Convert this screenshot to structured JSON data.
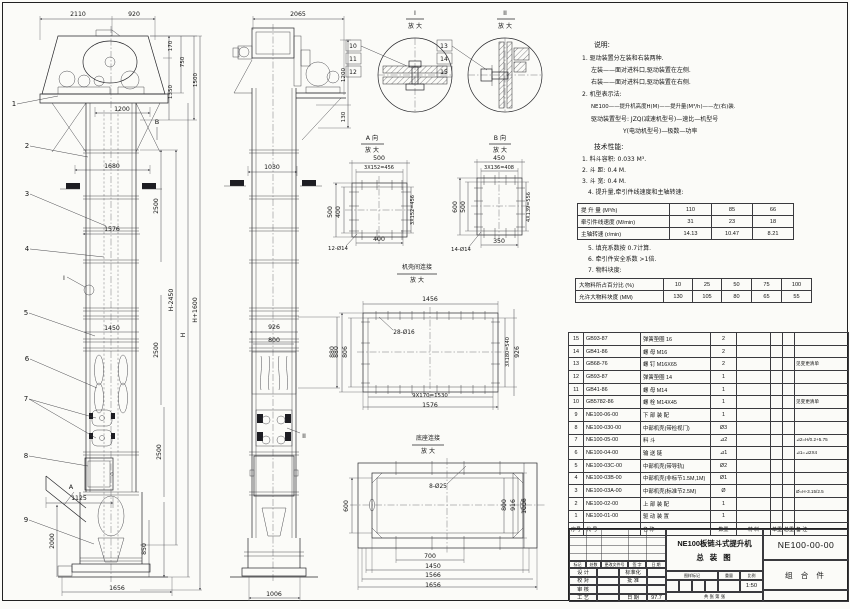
{
  "sheet": {
    "kind": "engineering-assembly-drawing"
  },
  "notes_labels": [
    [
      "说明:",
      594,
      47,
      0,
      6.8,
      "s"
    ],
    [
      "1. 驱动装置分左装和右装两种.",
      582,
      60,
      0,
      6,
      "s"
    ],
    [
      "左装——面对进料口,驱动装置在左侧.",
      591,
      72,
      0,
      6,
      "s"
    ],
    [
      "右装——面对进料口,驱动装置在右侧.",
      591,
      84,
      0,
      6,
      "s"
    ],
    [
      "2. 机型表示法:",
      582,
      96,
      0,
      6,
      "s"
    ],
    [
      "NE100——提升机高度H(M)——提升量(M³/h)——左(右)装.",
      591,
      108,
      0,
      5.4,
      "s"
    ],
    [
      "驱动装置型号: JZQ(减速机型号)—速比—机型号",
      591,
      121,
      0,
      6,
      "s"
    ],
    [
      "Y(电动机型号)—极数—功率",
      623,
      133,
      0,
      6,
      "s"
    ],
    [
      "技术性能:",
      594,
      149,
      0,
      6.8,
      "s"
    ],
    [
      "1. 料斗容积: 0.033 M³.",
      582,
      161,
      0,
      6,
      "s"
    ],
    [
      "2. 斗  距: 0.4 M.",
      582,
      172,
      0,
      6,
      "s"
    ],
    [
      "3. 斗  宽: 0.4 M.",
      582,
      183,
      0,
      6,
      "s"
    ],
    [
      "4. 提升量,牵引件线速度和主轴转速:",
      588,
      194,
      0,
      6,
      "s"
    ],
    [
      "5. 填充系数按 0.7计算.",
      588,
      250,
      0,
      6,
      "s"
    ],
    [
      "6. 牵引件安全系数 >1倍.",
      588,
      261,
      0,
      6,
      "s"
    ],
    [
      "7. 物料块度:",
      588,
      272,
      0,
      6,
      "s"
    ]
  ],
  "drawing_labels": [
    [
      "2110",
      78,
      16
    ],
    [
      "920",
      134,
      16
    ],
    [
      "170",
      172,
      46,
      -90,
      5.6
    ],
    [
      "750",
      184,
      62,
      -90,
      5.6
    ],
    [
      "1350",
      172,
      92,
      -90,
      5.6
    ],
    [
      "1500",
      197,
      80,
      -90,
      5.6
    ],
    [
      "1",
      14,
      106,
      0,
      7
    ],
    [
      "1200",
      122,
      111
    ],
    [
      "B",
      157,
      124,
      0,
      6.5
    ],
    [
      "2",
      27,
      148,
      0,
      7
    ],
    [
      "1680",
      112,
      168
    ],
    [
      "2500",
      158,
      206,
      -90
    ],
    [
      "3",
      27,
      196,
      0,
      7
    ],
    [
      "1576",
      112,
      231
    ],
    [
      "4",
      27,
      251,
      0,
      7
    ],
    [
      "I",
      64,
      280,
      0,
      6.5
    ],
    [
      "H-2450",
      173,
      300,
      -90
    ],
    [
      "H",
      185,
      335,
      -90
    ],
    [
      "H+1600",
      197,
      310,
      -90
    ],
    [
      "5",
      26,
      315,
      0,
      7
    ],
    [
      "1450",
      112,
      330
    ],
    [
      "2500",
      158,
      350,
      -90
    ],
    [
      "6",
      27,
      361,
      0,
      7
    ],
    [
      "7",
      26,
      401,
      0,
      7
    ],
    [
      "2500",
      161,
      452,
      -90
    ],
    [
      "8",
      26,
      458,
      0,
      7
    ],
    [
      "A",
      71,
      489,
      0,
      6.5
    ],
    [
      "1125",
      79,
      500
    ],
    [
      "9",
      26,
      522,
      0,
      7
    ],
    [
      "2000",
      54,
      541,
      -90
    ],
    [
      "850",
      146,
      549,
      -90
    ],
    [
      "1656",
      117,
      590
    ],
    [
      "2065",
      298,
      16
    ],
    [
      "1200",
      345,
      75,
      -90,
      5.6
    ],
    [
      "130",
      345,
      117,
      -90,
      5.6
    ],
    [
      "1030",
      272,
      169
    ],
    [
      "926",
      274,
      329
    ],
    [
      "800",
      274,
      342
    ],
    [
      "880",
      334,
      352,
      -90
    ],
    [
      "II",
      304,
      438,
      0,
      6.5
    ],
    [
      "1006",
      274,
      596
    ],
    [
      "I",
      415,
      15,
      0,
      6.5
    ],
    [
      "放 大",
      415,
      28,
      0,
      6
    ],
    [
      "10",
      353,
      48,
      0,
      6
    ],
    [
      "11",
      353,
      61,
      0,
      6
    ],
    [
      "12",
      353,
      74,
      0,
      6
    ],
    [
      "II",
      505,
      15,
      0,
      6.5
    ],
    [
      "放 大",
      505,
      28,
      0,
      6
    ],
    [
      "13",
      444,
      48,
      0,
      6
    ],
    [
      "14",
      444,
      61,
      0,
      6
    ],
    [
      "15",
      444,
      74,
      0,
      6
    ],
    [
      "A 向",
      372,
      140,
      0,
      6.2
    ],
    [
      "放 大",
      372,
      152,
      0,
      6
    ],
    [
      "500",
      379,
      160
    ],
    [
      "3X152=456",
      379,
      169,
      0,
      5
    ],
    [
      "500",
      332,
      212,
      -90
    ],
    [
      "400",
      340,
      212,
      -90
    ],
    [
      "3X152=456",
      414,
      210,
      -90,
      5
    ],
    [
      "400",
      379,
      241
    ],
    [
      "12-Ø14",
      338,
      250,
      0,
      5.4
    ],
    [
      "B 向",
      500,
      140,
      0,
      6.2
    ],
    [
      "放 大",
      500,
      152,
      0,
      6
    ],
    [
      "450",
      499,
      160
    ],
    [
      "3X136=408",
      499,
      169,
      0,
      5
    ],
    [
      "600",
      457,
      207,
      -90
    ],
    [
      "500",
      465,
      207,
      -90
    ],
    [
      "4X139=556",
      530,
      207,
      -90,
      5
    ],
    [
      "350",
      499,
      243
    ],
    [
      "14-Ø14",
      461,
      251,
      0,
      5.4
    ],
    [
      "机壳间连接",
      417,
      269,
      0,
      6
    ],
    [
      "放 大",
      417,
      282,
      0,
      6
    ],
    [
      "1456",
      430,
      301
    ],
    [
      "28-Ø16",
      404,
      334,
      0,
      5.8
    ],
    [
      "880",
      338,
      352,
      -90
    ],
    [
      "806",
      347,
      352,
      -90
    ],
    [
      "3X180=540",
      509,
      352,
      -90,
      5
    ],
    [
      "926",
      519,
      352,
      -90
    ],
    [
      "9X170=1530",
      430,
      397,
      0,
      5.4
    ],
    [
      "1576",
      430,
      407
    ],
    [
      "底座连接",
      428,
      440,
      0,
      6
    ],
    [
      "放 大",
      428,
      453,
      0,
      6
    ],
    [
      "8-Ø25",
      438,
      488,
      0,
      5.8
    ],
    [
      "600",
      348,
      506,
      -90
    ],
    [
      "800",
      506,
      505,
      -90
    ],
    [
      "916",
      515,
      505,
      -90
    ],
    [
      "1006",
      526,
      506,
      -90
    ],
    [
      "700",
      430,
      558
    ],
    [
      "1450",
      433,
      568
    ],
    [
      "1566",
      433,
      577
    ],
    [
      "1656",
      433,
      587
    ]
  ],
  "spec_table_lift": {
    "cols": [
      92,
      42,
      41,
      41
    ],
    "rows": [
      [
        "提 升 量  (M³/h)",
        "110",
        "85",
        "66"
      ],
      [
        "牵引件线速度 (M/min)",
        "31",
        "23",
        "18"
      ],
      [
        "主轴转速 (r/min)",
        "14.13",
        "10.47",
        "8.21"
      ]
    ]
  },
  "spec_table_lump": {
    "cols": [
      88,
      29,
      29,
      30,
      30,
      30
    ],
    "rows": [
      [
        "大物料所占百分比 (%)",
        "10",
        "25",
        "50",
        "75",
        "100"
      ],
      [
        "允许大物料块度 (MM)",
        "130",
        "105",
        "80",
        "65",
        "55"
      ]
    ]
  },
  "bom": {
    "cols": [
      15,
      57,
      70,
      26,
      34,
      12,
      12,
      54
    ],
    "rows": [
      [
        "15",
        "GB93-87",
        "弹簧垫圈 16",
        "2",
        "",
        "",
        "",
        ""
      ],
      [
        "14",
        "GB41-86",
        "螺 母 M16",
        "2",
        "",
        "",
        "",
        ""
      ],
      [
        "13",
        "GB68-76",
        "螺 钉 M16X65",
        "2",
        "",
        "",
        "",
        "见变更清单"
      ],
      [
        "12",
        "GB93-87",
        "弹簧垫圈 14",
        "1",
        "",
        "",
        "",
        ""
      ],
      [
        "11",
        "GB41-86",
        "螺 母 M14",
        "1",
        "",
        "",
        "",
        ""
      ],
      [
        "10",
        "GB5782-86",
        "螺 栓 M14X45",
        "1",
        "",
        "",
        "",
        "见变更清单"
      ],
      [
        "9",
        "NE100-06-00",
        "下 部 装 配",
        "1",
        "",
        "",
        "",
        ""
      ],
      [
        "8",
        "NE100-030-00",
        "中部机壳(带检视门)",
        "Ø3",
        "",
        "",
        "",
        ""
      ],
      [
        "7",
        "NE100-05-00",
        "料 斗",
        "⊿2",
        "",
        "",
        "",
        "⊿2=H/0.2+5.75"
      ],
      [
        "6",
        "NE100-04-00",
        "输 送 链",
        "⊿1",
        "",
        "",
        "",
        "⊿1=⊿2X4"
      ],
      [
        "5",
        "NE100-03C-00",
        "中部机壳(带导轨)",
        "Ø2",
        "",
        "",
        "",
        ""
      ],
      [
        "4",
        "NE100-03B-00",
        "中部机壳(非标节1.5M,1M)",
        "Ø1",
        "",
        "",
        "",
        ""
      ],
      [
        "3",
        "NE100-03A-00",
        "中部机壳(标准节2.5M)",
        "Ø",
        "",
        "",
        "",
        "Ø=H-3.15/2.5"
      ],
      [
        "2",
        "NE100-02-00",
        "上 部 装 配",
        "1",
        "",
        "",
        "",
        ""
      ],
      [
        "1",
        "NE100-01-00",
        "驱 动 装 置",
        "1",
        "",
        "",
        "",
        ""
      ]
    ],
    "footer": [
      "序号",
      "代  号",
      "名  称",
      "数量",
      "材  料",
      "单重",
      "总重",
      "备  注"
    ]
  },
  "title_block": {
    "product": "NE100板链斗式提升机",
    "drawing_name": "总  装  图",
    "code": "NE100-00-00",
    "part_class": "组  合  件",
    "rev_headers": [
      "标记",
      "处数",
      "更改文件号",
      "签 字",
      "日 期"
    ],
    "sign_rows": [
      [
        "设 计",
        "",
        "标准化",
        ""
      ],
      [
        "校 对",
        "",
        "批 准",
        ""
      ],
      [
        "审 核",
        "",
        "",
        ""
      ],
      [
        "工 艺",
        "",
        "日 期",
        "97.7"
      ]
    ],
    "stamp_headers": [
      "图样标记",
      "重量",
      "比例"
    ],
    "scale": "1:50",
    "sheet_note": "共  张  第  张"
  }
}
